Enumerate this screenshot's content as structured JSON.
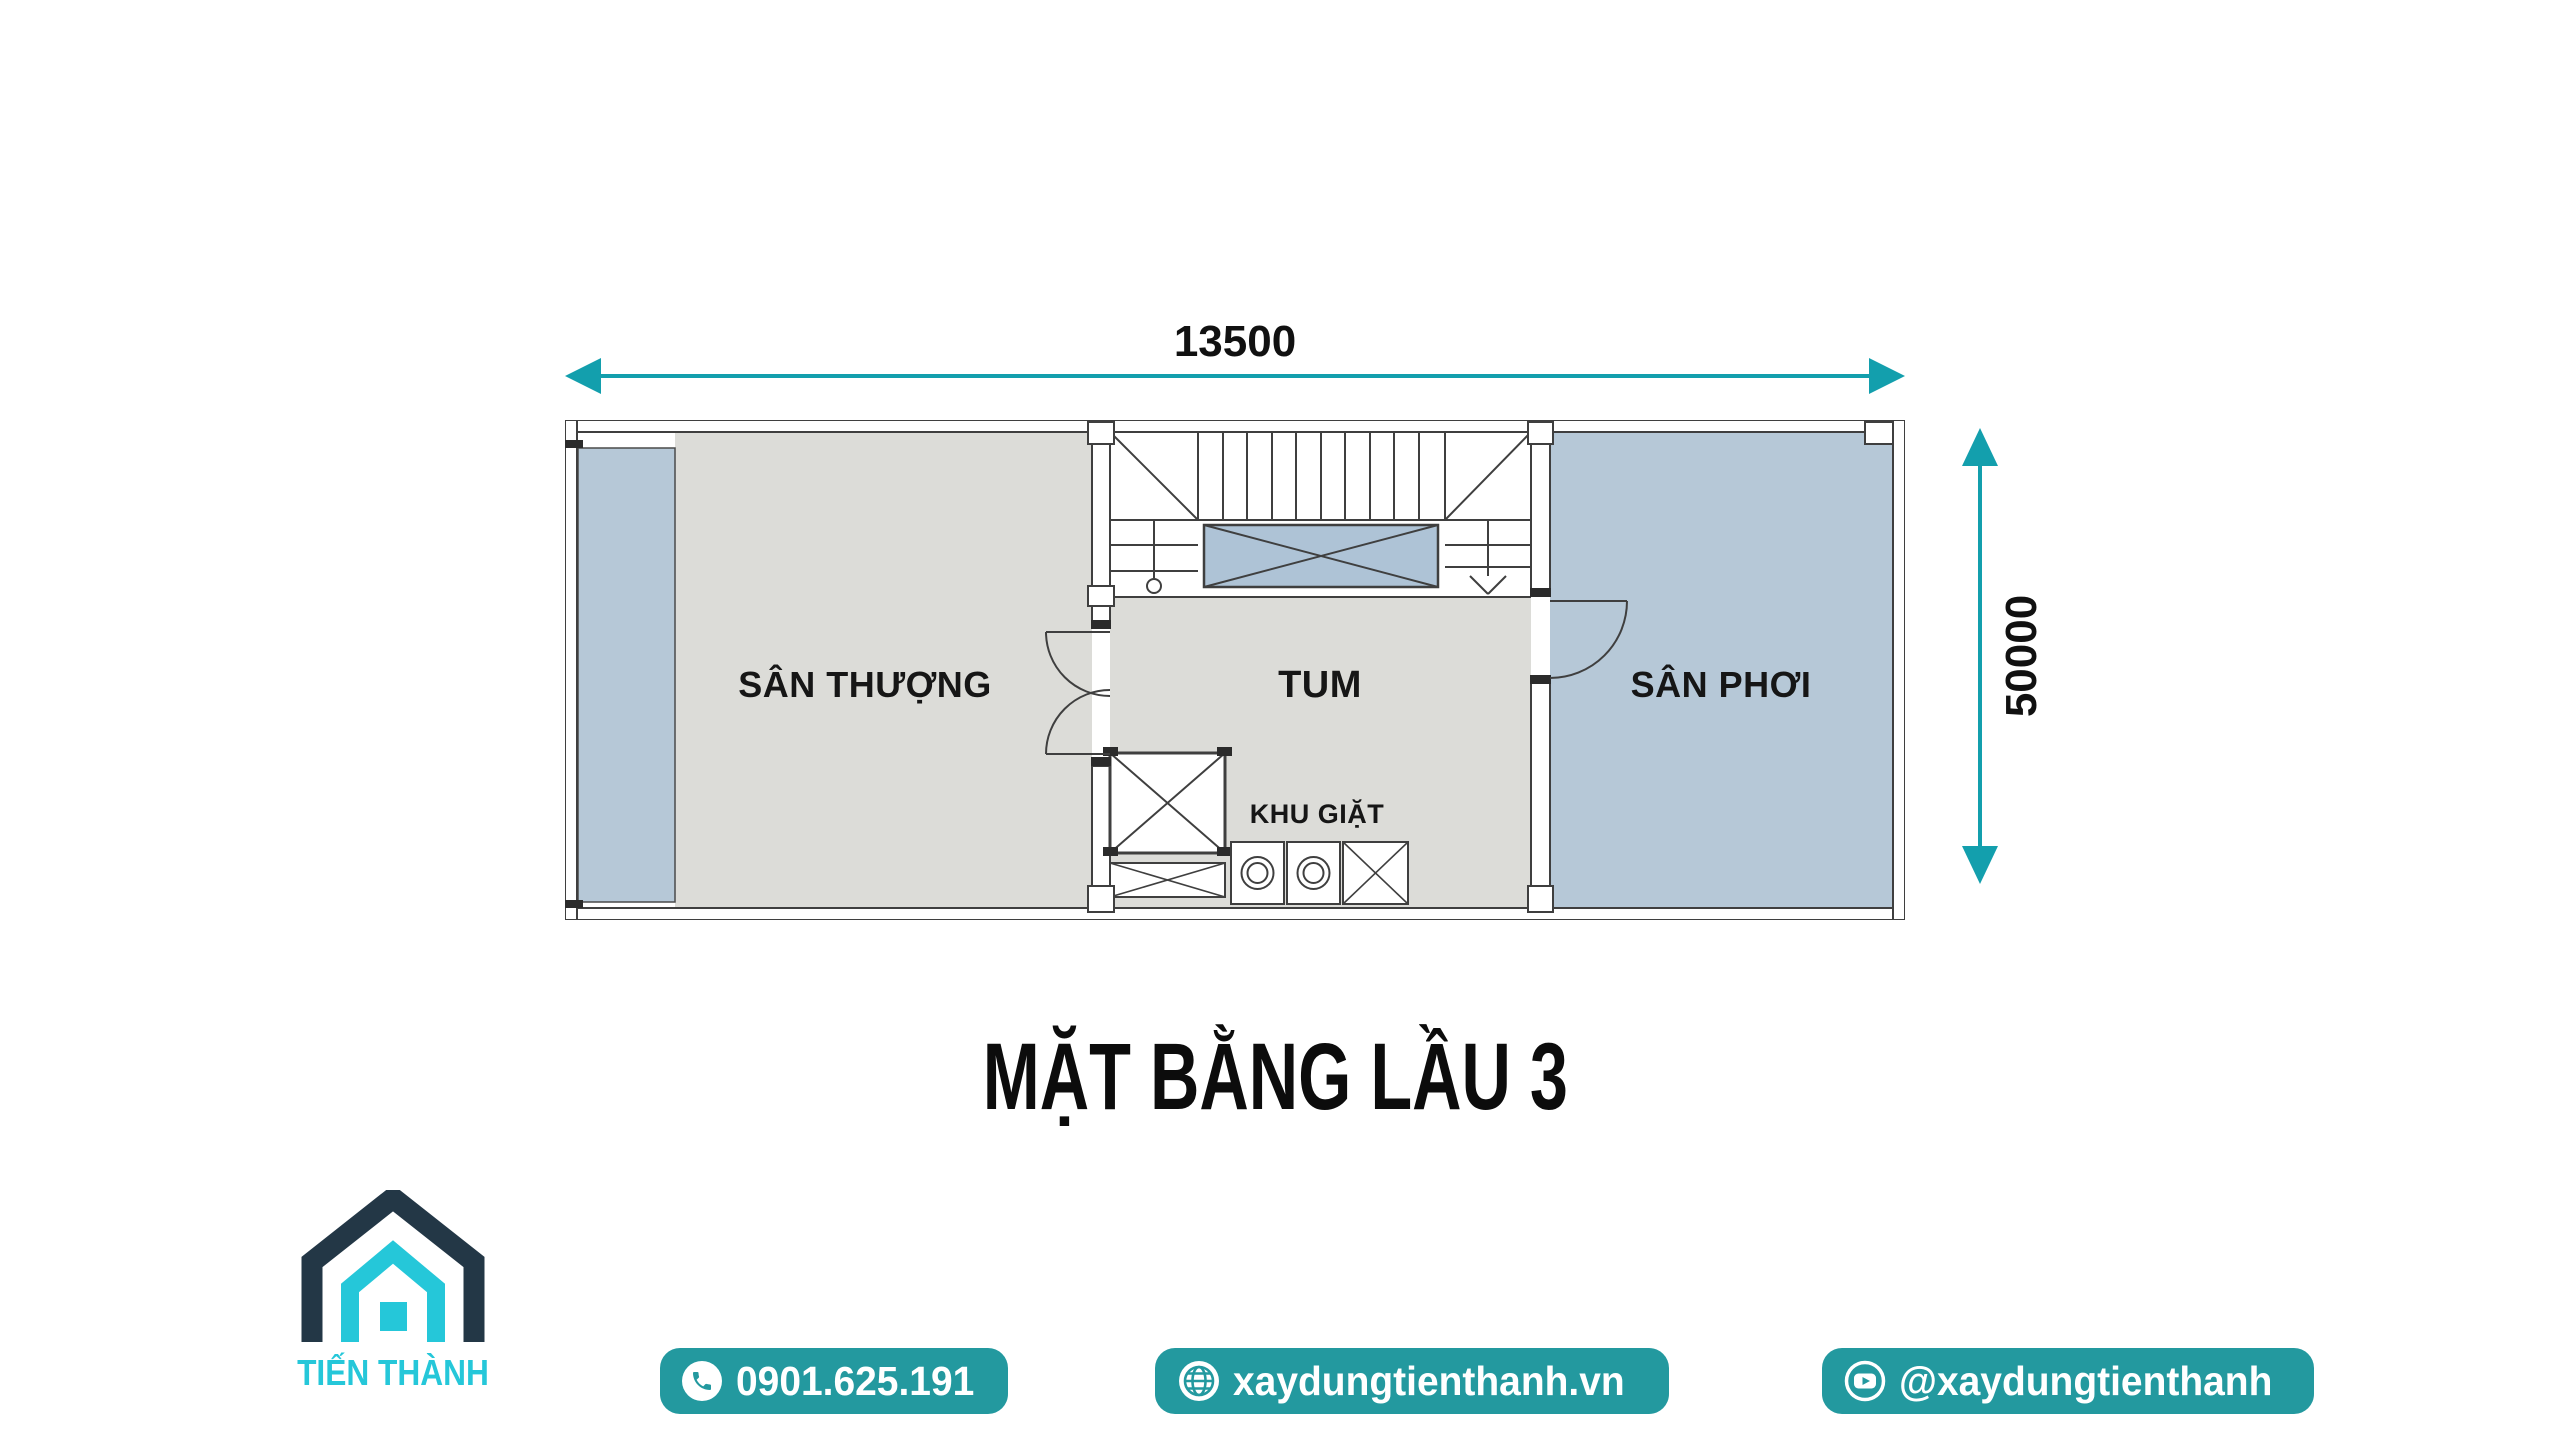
{
  "page": {
    "background": "#ffffff"
  },
  "plan": {
    "title": "MẶT BẰNG LẦU 3",
    "dimension_width": "13500",
    "dimension_height": "50000",
    "rooms": {
      "terrace": "SÂN THƯỢNG",
      "attic": "TUM",
      "drying_yard": "SÂN PHƠI",
      "laundry": "KHU GIẶT"
    },
    "colors": {
      "floor_gray": "#dcdcd8",
      "floor_blue": "#b6c8d7",
      "void_blue": "#aec3d6",
      "line": "#3f3f3f",
      "dimension_teal": "#139fad"
    }
  },
  "branding": {
    "logo_name": "TIẾN THÀNH",
    "logo_navy": "#233746",
    "logo_cyan": "#25c7d9",
    "pill_color": "#23999f",
    "contacts": [
      {
        "icon": "phone",
        "label": "0901.625.191"
      },
      {
        "icon": "globe",
        "label": "xaydungtienthanh.vn"
      },
      {
        "icon": "youtube",
        "label": "@xaydungtienthanh"
      }
    ]
  }
}
